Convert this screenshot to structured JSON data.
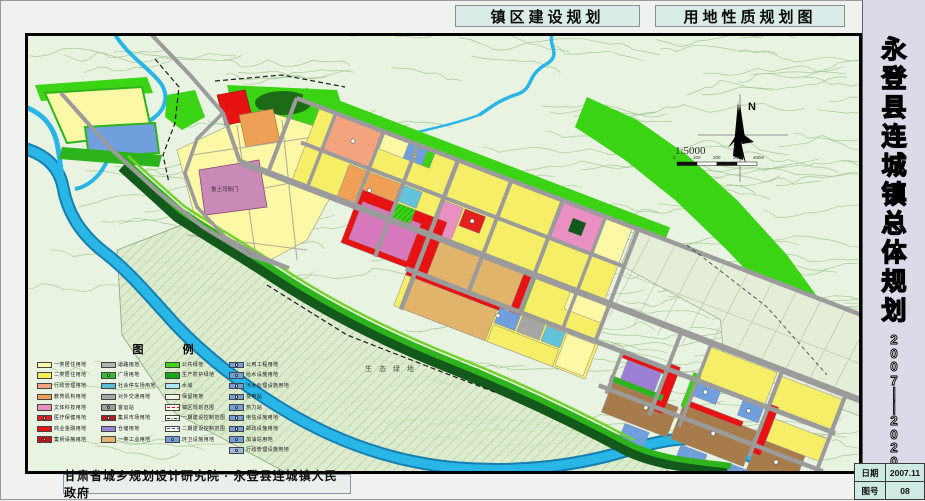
{
  "headers": {
    "left": "镇区建设规划",
    "right": "用地性质规划图"
  },
  "title_panel": {
    "title": "永登县连城镇总体规划",
    "title_chars": [
      "永",
      "登",
      "县",
      "连",
      "城",
      "镇",
      "总",
      "体",
      "规",
      "划"
    ],
    "period_chars": [
      "2",
      "0",
      "0",
      "7",
      "—",
      "—",
      "2",
      "0",
      "2",
      "0"
    ],
    "info": {
      "date_label": "日期",
      "date_value": "2007.11",
      "sheet_label": "图号",
      "sheet_value": "08"
    }
  },
  "footer": {
    "credit": "甘肃省城乡规划设计研究院 · 永登县连城镇人民政府"
  },
  "map": {
    "compass_label": "N",
    "scale": {
      "text": "1:5000",
      "ticks": [
        "0",
        "100",
        "200",
        "300",
        "400m"
      ]
    },
    "labels": {
      "historic_site": "鲁土司衙门",
      "eco_green": "生 态 绿 地"
    },
    "legend": {
      "title": "图 例",
      "columns": [
        [
          {
            "label": "一类居住用地",
            "color": "#fdf8a6",
            "type": "solid"
          },
          {
            "label": "二类居住用地",
            "color": "#f6ec55",
            "type": "solid"
          },
          {
            "label": "行政管理用地",
            "color": "#f3a47e",
            "type": "solid"
          },
          {
            "label": "教育机构用地",
            "color": "#efa057",
            "type": "solid"
          },
          {
            "label": "文体科技用地",
            "color": "#e98fc1",
            "type": "solid"
          },
          {
            "label": "医疗保健用地",
            "color": "#e41f1f",
            "type": "solid",
            "symbol": "cross"
          },
          {
            "label": "商业金融用地",
            "color": "#e81313",
            "type": "solid"
          },
          {
            "label": "集贸设施用地",
            "color": "#c41111",
            "type": "solid",
            "symbol": "dot"
          }
        ],
        [
          {
            "label": "道路用地",
            "color": "#b3b3b3",
            "type": "solid"
          },
          {
            "label": "广场用地",
            "color": "#2fbf30",
            "type": "solid",
            "symbol": "dot"
          },
          {
            "label": "社会停车场用地",
            "color": "#5cbcd6",
            "type": "solid"
          },
          {
            "label": "对外交通用地",
            "color": "#a8a8a8",
            "type": "solid"
          },
          {
            "label": "客运站",
            "color": "#9d9d9d",
            "type": "solid",
            "symbol": "P"
          },
          {
            "label": "集贸市场用地",
            "color": "#b81c1c",
            "type": "solid",
            "symbol": "dot"
          },
          {
            "label": "仓储用地",
            "color": "#9b80d5",
            "type": "solid"
          },
          {
            "label": "一类工业用地",
            "color": "#dfb26e",
            "type": "solid"
          }
        ],
        [
          {
            "label": "公共绿地",
            "color": "#3cd911",
            "type": "solid"
          },
          {
            "label": "生产防护绿地",
            "color": "#18a618",
            "type": "solid"
          },
          {
            "label": "水域",
            "color": "#abe6f2",
            "type": "solid"
          },
          {
            "label": "保留用地",
            "color": "#eef2e0",
            "type": "solid"
          },
          {
            "label": "镇区规划范围",
            "color": "#e00000",
            "type": "line-red-dash"
          },
          {
            "label": "一期建设控制范围",
            "color": "#333333",
            "type": "line-dashdot"
          },
          {
            "label": "二期建设控制范围",
            "color": "#2a5ad0",
            "type": "line-dash"
          },
          {
            "label": "环卫设施用地",
            "color": "#6f9fdd",
            "type": "solid",
            "symbol": "dot"
          }
        ],
        [
          {
            "label": "公用工程用地",
            "color": "#6f9fdd",
            "type": "solid",
            "symbol": "dot"
          },
          {
            "label": "给水设施用地",
            "color": "#6f9fdd",
            "type": "solid",
            "symbol": "dot"
          },
          {
            "label": "污水处理设施用地",
            "color": "#6f9fdd",
            "type": "solid",
            "symbol": "dot"
          },
          {
            "label": "变电站",
            "color": "#6f9fdd",
            "type": "solid",
            "symbol": "dot"
          },
          {
            "label": "热力站",
            "color": "#6f9fdd",
            "type": "solid",
            "symbol": "dot"
          },
          {
            "label": "电信设施用地",
            "color": "#6f9fdd",
            "type": "solid",
            "symbol": "dot"
          },
          {
            "label": "邮政设施用地",
            "color": "#6f9fdd",
            "type": "solid",
            "symbol": "dot"
          },
          {
            "label": "加油站用地",
            "color": "#6f9fdd",
            "type": "solid",
            "symbol": "dot"
          },
          {
            "label": "行政管理设施用地",
            "color": "#9fb9e4",
            "type": "solid",
            "symbol": "dot"
          }
        ]
      ]
    },
    "palette": {
      "bg": "#e9f3e2",
      "contour": "#9cc487",
      "water": "#29b5e6",
      "waterEdge": "#157fb0",
      "res1": "#fdf8a6",
      "res2": "#f6ee66",
      "admin": "#f3a47e",
      "edu": "#efa057",
      "culture": "#e98fc1",
      "magenta": "#d878bc",
      "medical": "#e41f1f",
      "commercial": "#e81212",
      "road": "#9b9b9b",
      "parking": "#62c3da",
      "transport": "#a6a6a6",
      "warehouse": "#9b80d5",
      "industry1": "#e2b36a",
      "industry2": "#a87b4b",
      "utility": "#6f9fdd",
      "greenBright": "#3ad414",
      "greenMid": "#2db31c",
      "greenDark": "#14591c",
      "reserved": "#e4edd6",
      "historic": "#c98ab8",
      "ecoBase": "#d9e9c9",
      "ecoHatch": "#7fae60"
    }
  }
}
